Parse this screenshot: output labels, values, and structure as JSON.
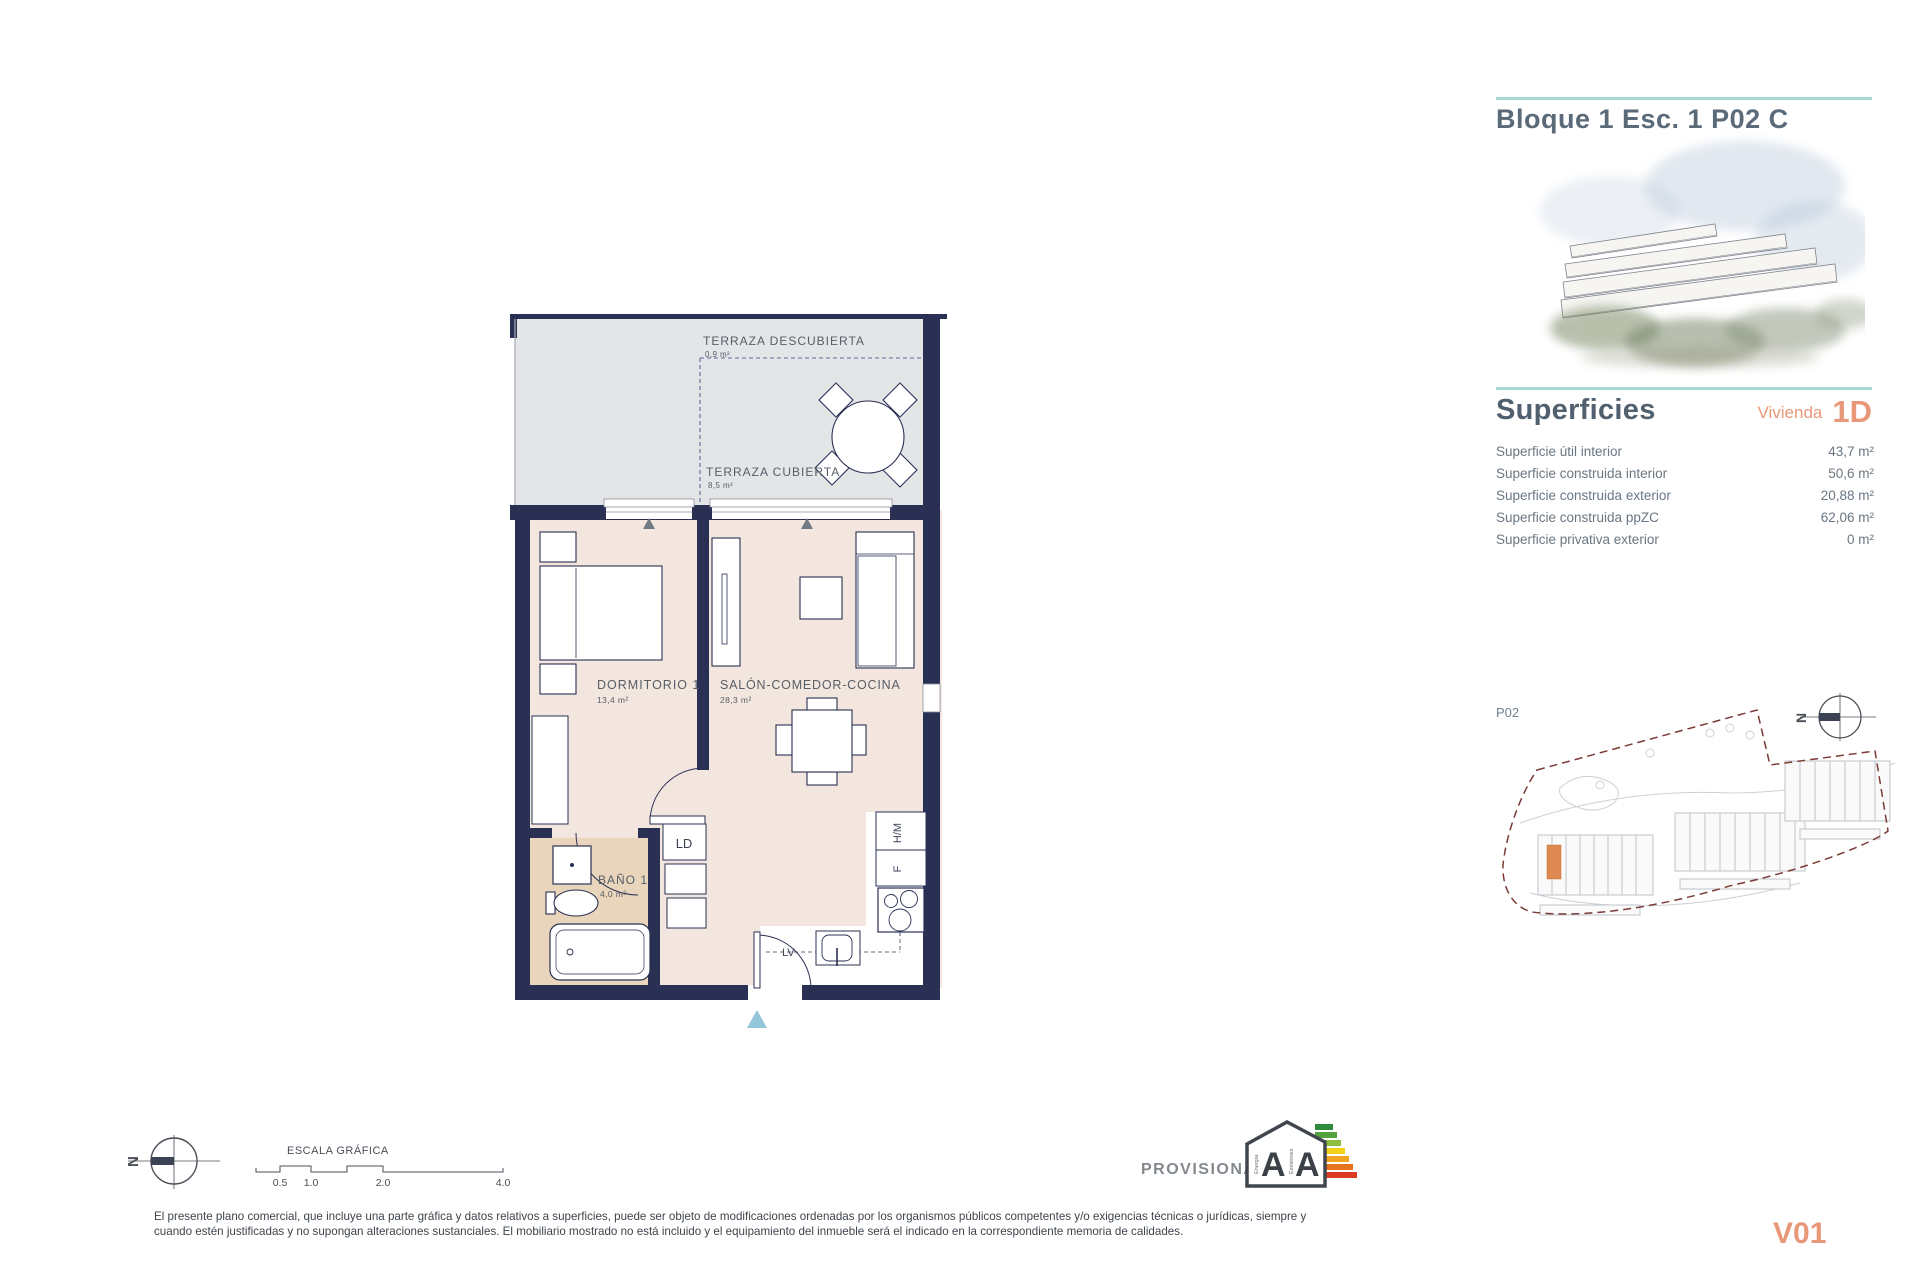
{
  "colors": {
    "wall_navy": "#2a3053",
    "floor_pink": "#f3e6de",
    "floor_bath": "#e8d5bb",
    "terrace_gray": "#e4e5e7",
    "teal_accent": "#a5d8d2",
    "orange_accent": "#e89878",
    "site_boundary": "#7b3a35",
    "entry_triangle": "#93c6d8"
  },
  "header": {
    "title": "Bloque 1 Esc. 1 P02 C"
  },
  "superficies": {
    "heading": "Superficies",
    "vivienda_label": "Vivienda",
    "vivienda_code": "1D",
    "rows": [
      {
        "label": "Superficie útil interior",
        "value": "43,7 m²"
      },
      {
        "label": "Superficie construida interior",
        "value": "50,6 m²"
      },
      {
        "label": "Superficie construida exterior",
        "value": "20,88 m²"
      },
      {
        "label": "Superficie construida ppZC",
        "value": "62,06 m²"
      },
      {
        "label": "Superficie privativa exterior",
        "value": "0 m²"
      }
    ]
  },
  "floorplan": {
    "terraza_descubierta": {
      "name": "TERRAZA DESCUBIERTA",
      "area": "0,9 m²"
    },
    "terraza_cubierta": {
      "name": "TERRAZA CUBIERTA",
      "area": "8,5 m²"
    },
    "dormitorio": {
      "name": "DORMITORIO 1",
      "area": "13,4 m²"
    },
    "salon": {
      "name": "SALÓN-COMEDOR-COCINA",
      "area": "28,3 m²"
    },
    "bano": {
      "name": "BAÑO 1",
      "area": "4,0 m²"
    },
    "kitchen_codes": {
      "ld": "LD",
      "hm": "H/M",
      "f": "F",
      "lv": "LV"
    }
  },
  "siteplan": {
    "label": "P02",
    "compass_letter": "N"
  },
  "footer": {
    "compass_letter": "N",
    "scale_label": "ESCALA GRÁFICA",
    "scale_ticks": [
      "0.5",
      "1.0",
      "2.0",
      "4.0"
    ],
    "provisional": "PROVISIONAL",
    "energy": {
      "letter_energy": "A",
      "letter_emissions": "A",
      "caption_energy": "Energía",
      "caption_emissions": "Emisiones"
    },
    "disclaimer_line1": "El presente plano comercial, que incluye una parte gráfica y datos relativos a superficies, puede ser objeto de modificaciones ordenadas por los organismos públicos competentes y/o exigencias técnicas o jurídicas, siempre y",
    "disclaimer_line2": "cuando estén justificadas y no supongan alteraciones sustanciales. El mobiliario mostrado no está incluido y el equipamiento del inmueble será el indicado en la correspondiente memoria de calidades.",
    "version": "V01"
  }
}
